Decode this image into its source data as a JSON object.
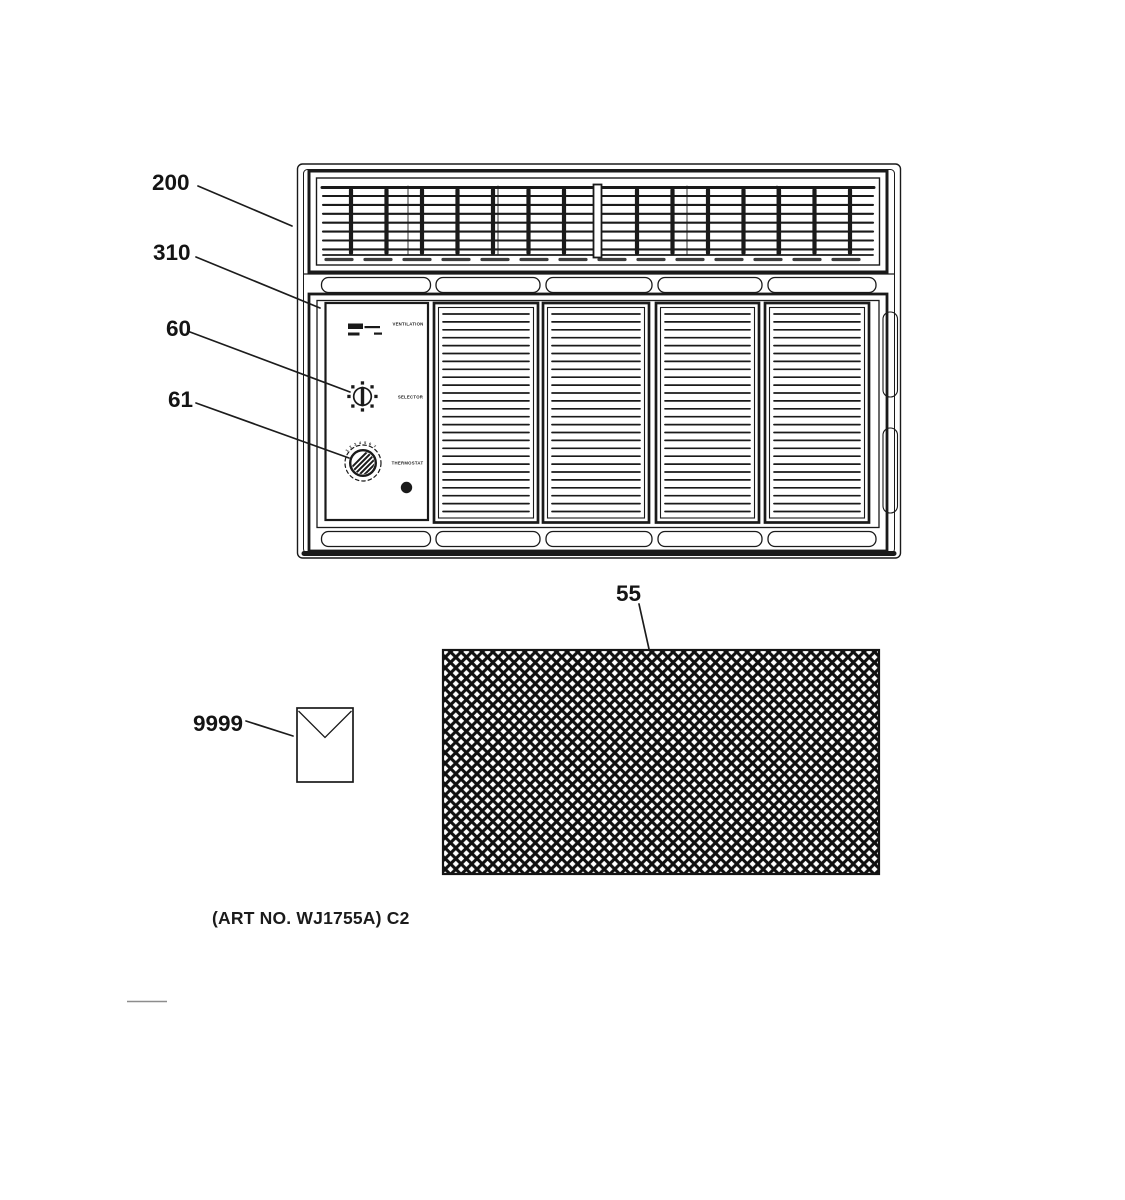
{
  "figure": {
    "art_no": "(ART NO. WJ1755A) C2",
    "callouts": {
      "grille": "200",
      "front_panel": "310",
      "selector_knob": "60",
      "thermostat_knob": "61",
      "filter": "55",
      "literature_envelope": "9999"
    },
    "control_panel": {
      "ventilation_label": "VENTILATION",
      "selector_label": "SELECTOR",
      "thermostat_label": "THERMOSTAT",
      "thermostat_scale": "1 2 3 4 5 6 7"
    },
    "colors": {
      "ink": "#1a1a1a",
      "paper": "#ffffff"
    }
  }
}
